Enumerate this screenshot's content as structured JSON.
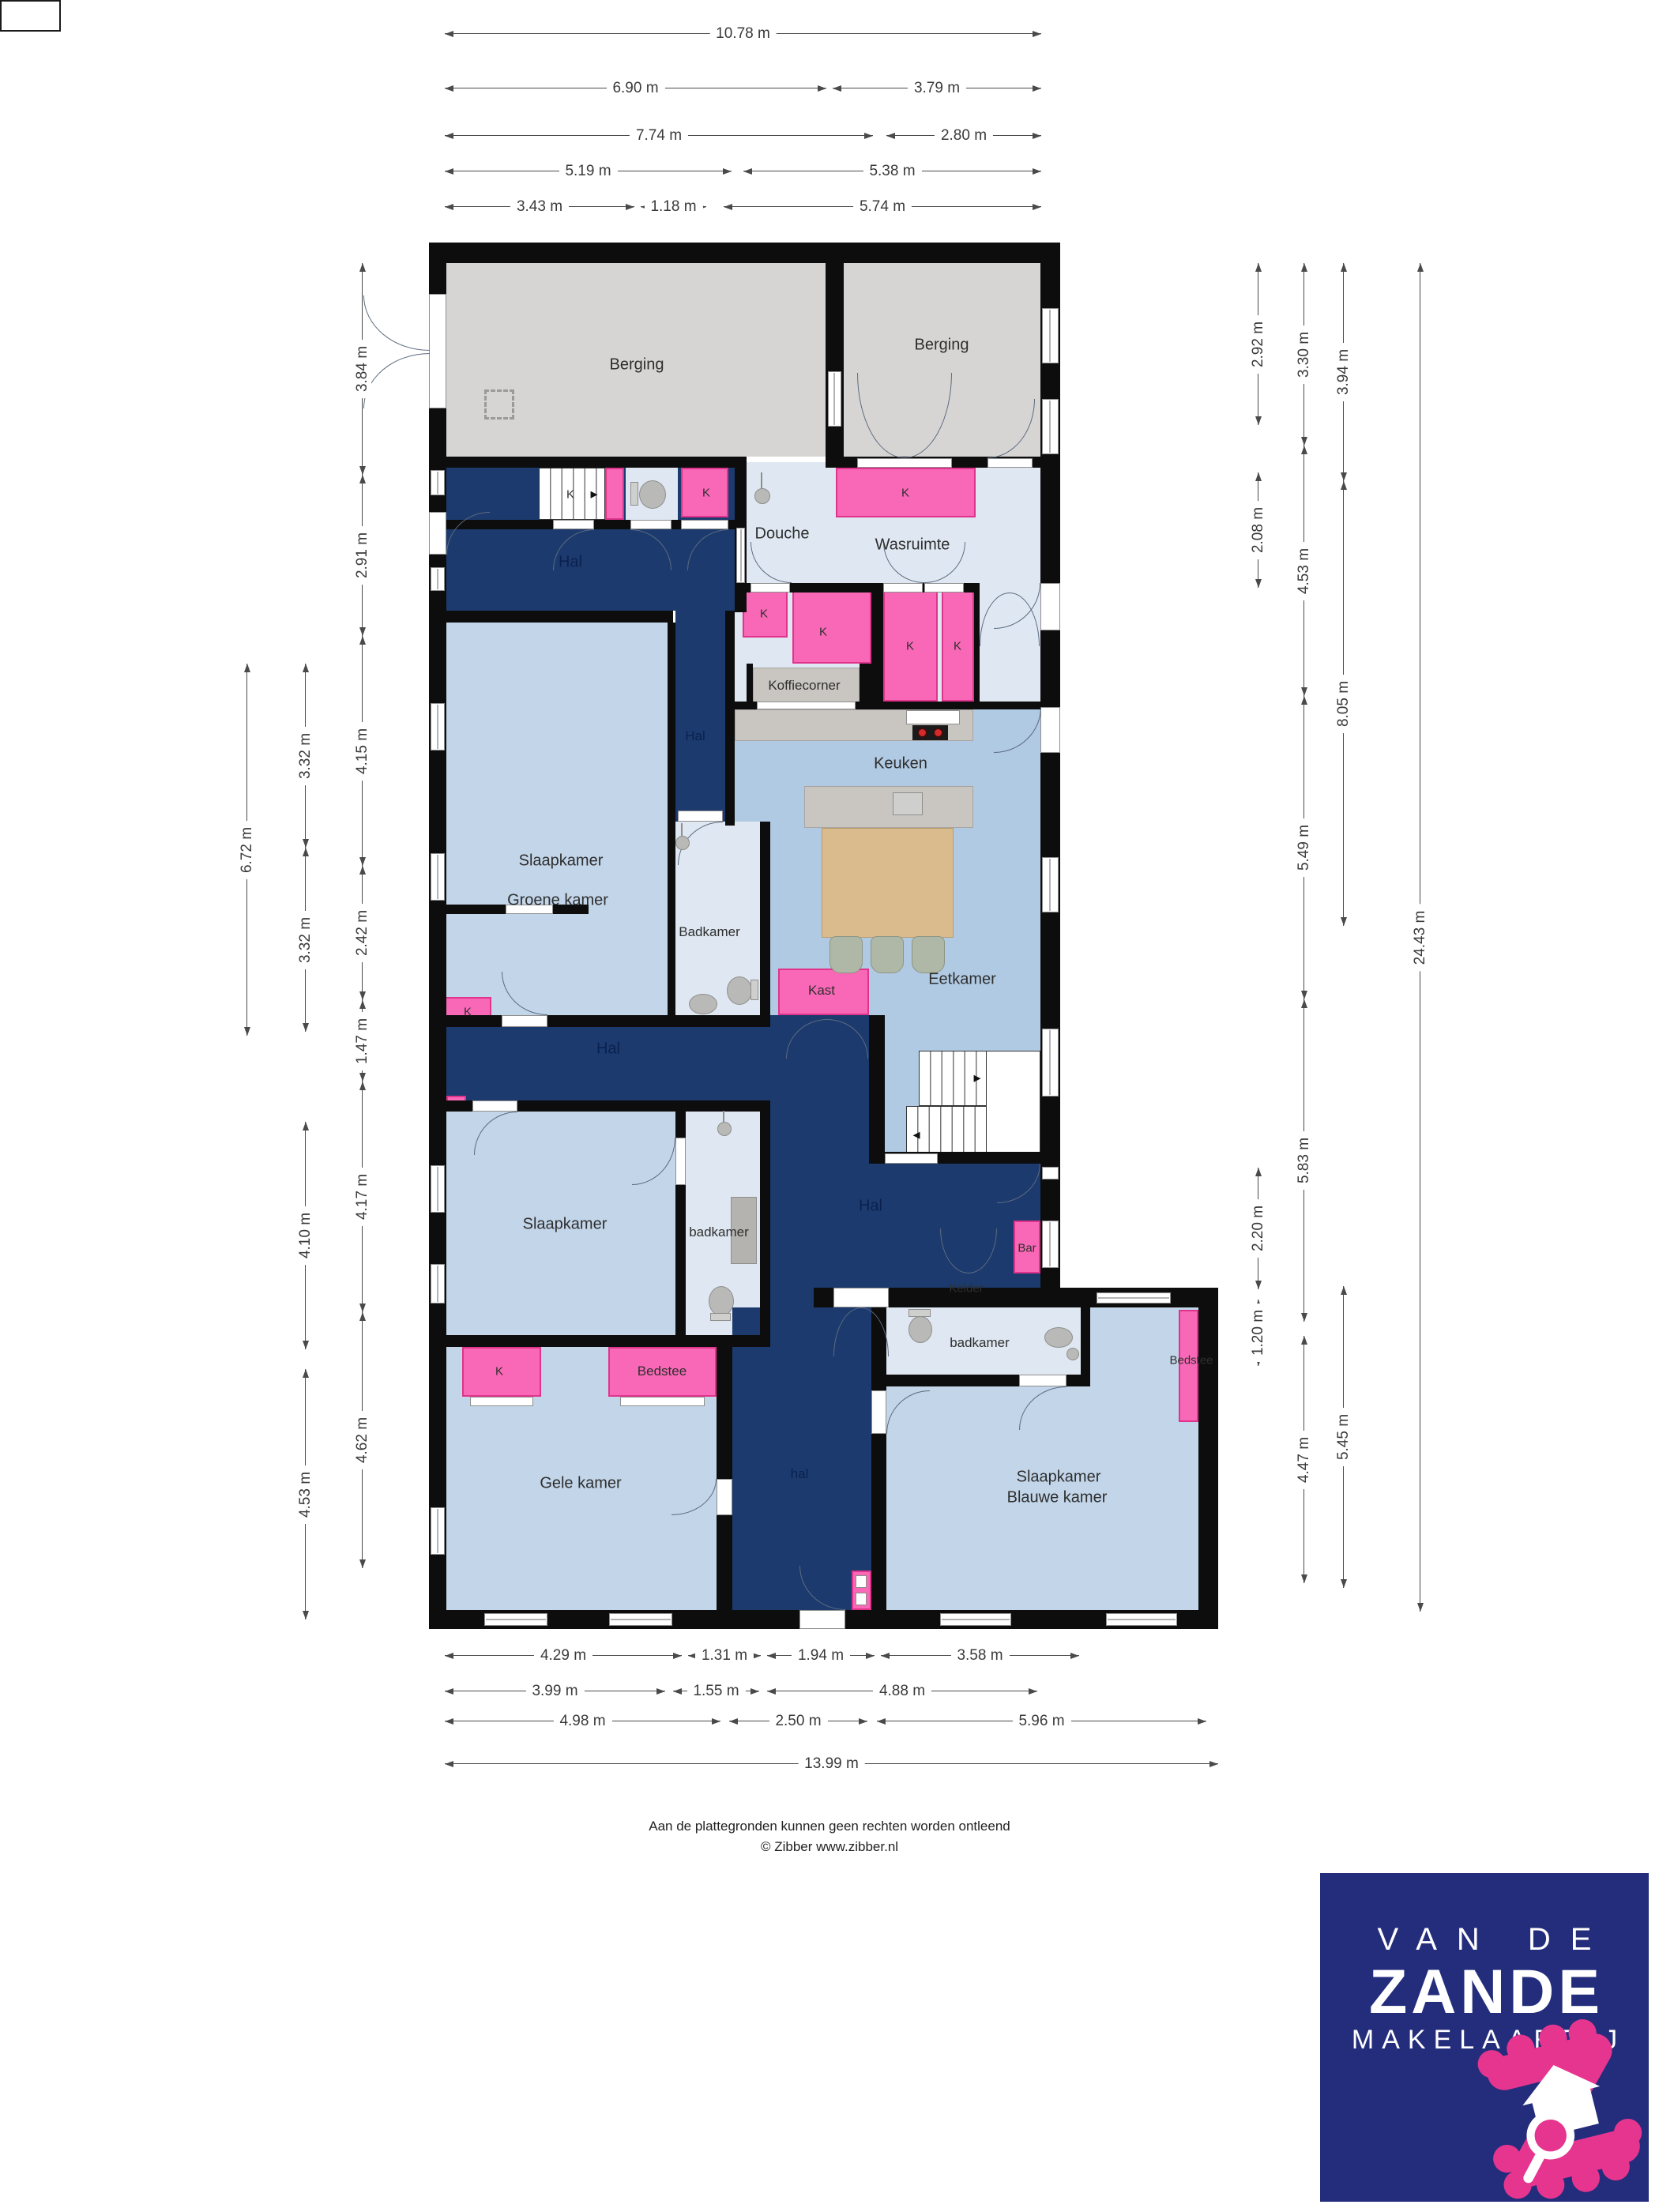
{
  "plan": {
    "closet_label": "K",
    "rooms": {
      "berging_left": "Berging",
      "berging_right": "Berging",
      "douche": "Douche",
      "wasruimte": "Wasruimte",
      "hal_top": "Hal",
      "hal_corridor": "Hal",
      "slaapkamer_groene_1": "Slaapkamer",
      "slaapkamer_groene_2": "Groene kamer",
      "koffiecorner": "Koffiecorner",
      "keuken": "Keuken",
      "badkamer_top": "Badkamer",
      "eetkamer": "Eetkamer",
      "kast": "Kast",
      "hal_mid": "Hal",
      "slaapkamer_mid": "Slaapkamer",
      "badkamer_mid": "badkamer",
      "hal_central": "Hal",
      "bar": "Bar",
      "kelder": "Kelder",
      "badkamer_right": "badkamer",
      "bedstee_right": "Bedstee",
      "bedstee_left": "Bedstee",
      "gele_kamer": "Gele kamer",
      "hal_bottom": "hal",
      "slaapkamer_blauwe_1": "Slaapkamer",
      "slaapkamer_blauwe_2": "Blauwe kamer"
    }
  },
  "dims": {
    "top": [
      [
        "10.78 m"
      ],
      [
        "6.90 m",
        "3.79 m"
      ],
      [
        "7.74 m",
        "2.80 m"
      ],
      [
        "5.19 m",
        "5.38 m"
      ],
      [
        "3.43 m",
        "1.18 m",
        "5.74 m"
      ]
    ],
    "bottom": [
      [
        "4.29 m",
        "1.31 m",
        "1.94 m",
        "3.58 m"
      ],
      [
        "3.99 m",
        "1.55 m",
        "4.88 m"
      ],
      [
        "4.98 m",
        "2.50 m",
        "5.96 m"
      ],
      [
        "13.99 m"
      ]
    ],
    "left": {
      "a": [
        "6.72 m"
      ],
      "b": [
        "3.32 m",
        "3.32 m",
        "4.10 m",
        "4.53 m"
      ],
      "c": [
        "3.84 m",
        "2.91 m",
        "4.15 m",
        "2.42 m",
        "1.47 m",
        "4.17 m",
        "4.62 m"
      ]
    },
    "right": {
      "r1": [
        "2.92 m",
        "2.08 m",
        "2.20 m",
        "1.20 m"
      ],
      "r2": [
        "3.30 m",
        "4.53 m",
        "5.49 m",
        "5.83 m",
        "4.47 m"
      ],
      "r3": [
        "3.94 m",
        "8.05 m",
        "5.45 m"
      ],
      "r4": [
        "24.43 m"
      ]
    }
  },
  "footer": {
    "line1": "Aan de plattegronden kunnen geen rechten worden ontleend",
    "line2": "© Zibber www.zibber.nl"
  },
  "logo": {
    "line1": "VAN DE",
    "line2": "ZANDE",
    "line3": "MAKELAARDIJ"
  },
  "colors": {
    "wall": "#0d0d0d",
    "hall_dark_blue": "#1c3a6d",
    "bedroom_blue": "#c2d5e9",
    "kitchen_blue": "#b0cae3",
    "bathroom_light": "#dfe8f2",
    "storage_grey": "#d6d5d3",
    "closet_pink": "#f868b6",
    "logo_navy": "#232d7b",
    "logo_pink": "#e6358f"
  }
}
